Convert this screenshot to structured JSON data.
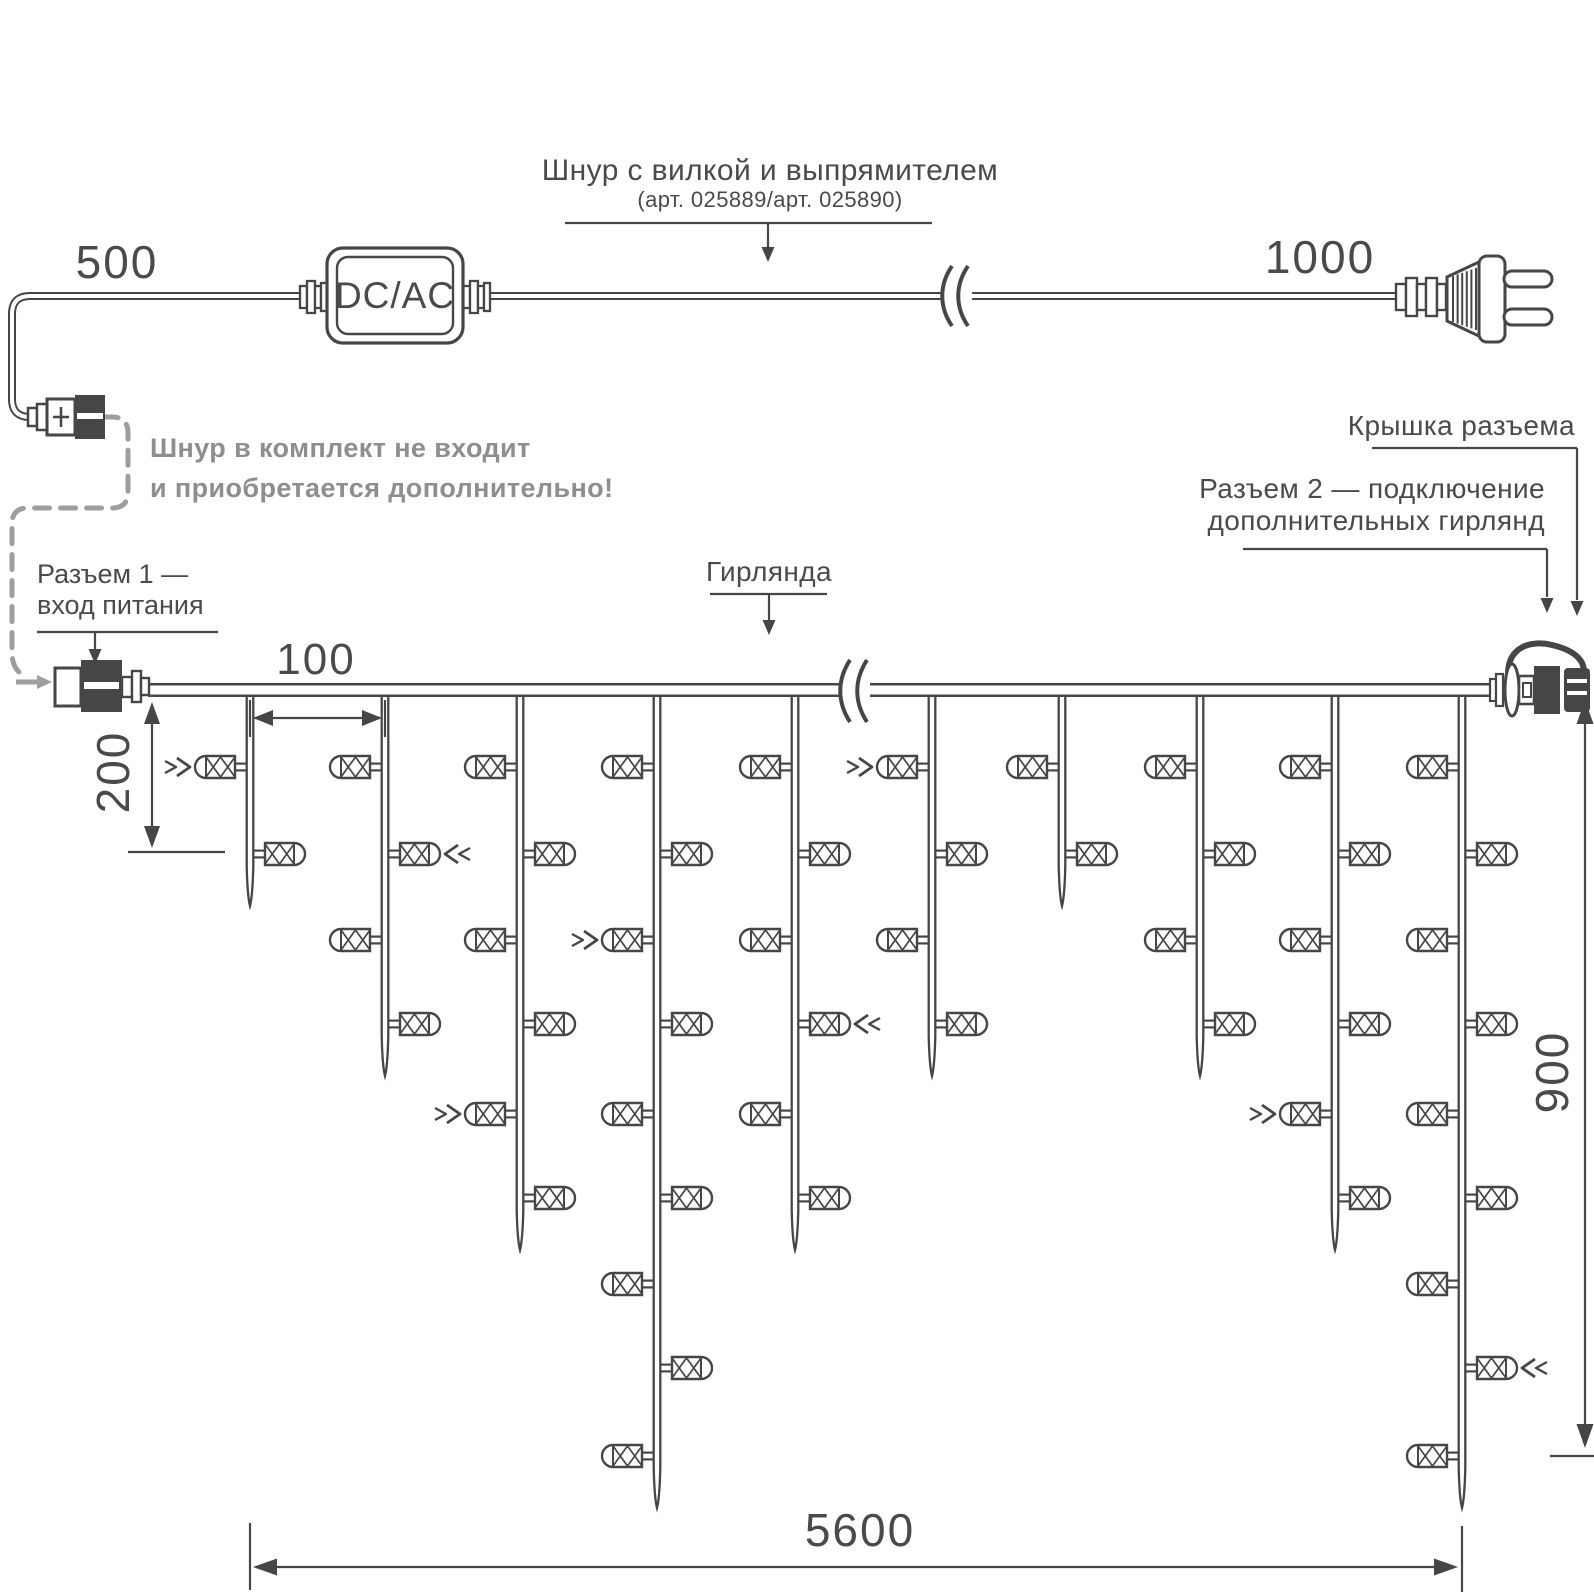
{
  "colors": {
    "line": "#464646",
    "text": "#4a4a4a",
    "muted": "#8e8e8e",
    "dash": "#9e9e9e"
  },
  "cord": {
    "title": "Шнур с вилкой и выпрямителем",
    "subtitle": "(арт. 025889/арт. 025890)",
    "converter_label": "DC/AC",
    "left_length": "500",
    "right_length": "1000",
    "note_line1": "Шнур в комплект не входит",
    "note_line2": "и приобретается дополнительно!"
  },
  "garland": {
    "label": "Гирлянда",
    "connector1_line1": "Разъем 1 —",
    "connector1_line2": "вход питания",
    "cap_label": "Крышка разъема",
    "connector2_line1": "Разъем 2 — подключение",
    "connector2_line2": "дополнительных гирлянд",
    "drop_spacing_label": "100",
    "first_led_offset_label": "200",
    "height_label": "900",
    "total_length_label": "5600"
  },
  "diagram": {
    "wire_y": 690,
    "wire_x1": 148,
    "wire_x2": 1492,
    "break_x": 854,
    "cord_y": 296,
    "cord_break_x": 956,
    "led_rows_y": [
      767,
      854,
      940,
      1024,
      1114,
      1198,
      1284,
      1368,
      1456
    ],
    "drops": [
      {
        "x": 250,
        "leds": 2,
        "flash_row": 1
      },
      {
        "x": 385,
        "leds": 4,
        "flash_row": 2
      },
      {
        "x": 520,
        "leds": 6,
        "flash_row": 5
      },
      {
        "x": 657,
        "leds": 9,
        "flash_row": 3
      },
      {
        "x": 795,
        "leds": 6,
        "flash_row": 4
      },
      {
        "x": 932,
        "leds": 4,
        "flash_row": 1
      },
      {
        "x": 1062,
        "leds": 2,
        "flash_row": 0
      },
      {
        "x": 1200,
        "leds": 4,
        "flash_row": 0
      },
      {
        "x": 1335,
        "leds": 6,
        "flash_row": 5
      },
      {
        "x": 1462,
        "leds": 9,
        "flash_row": 8
      }
    ]
  }
}
